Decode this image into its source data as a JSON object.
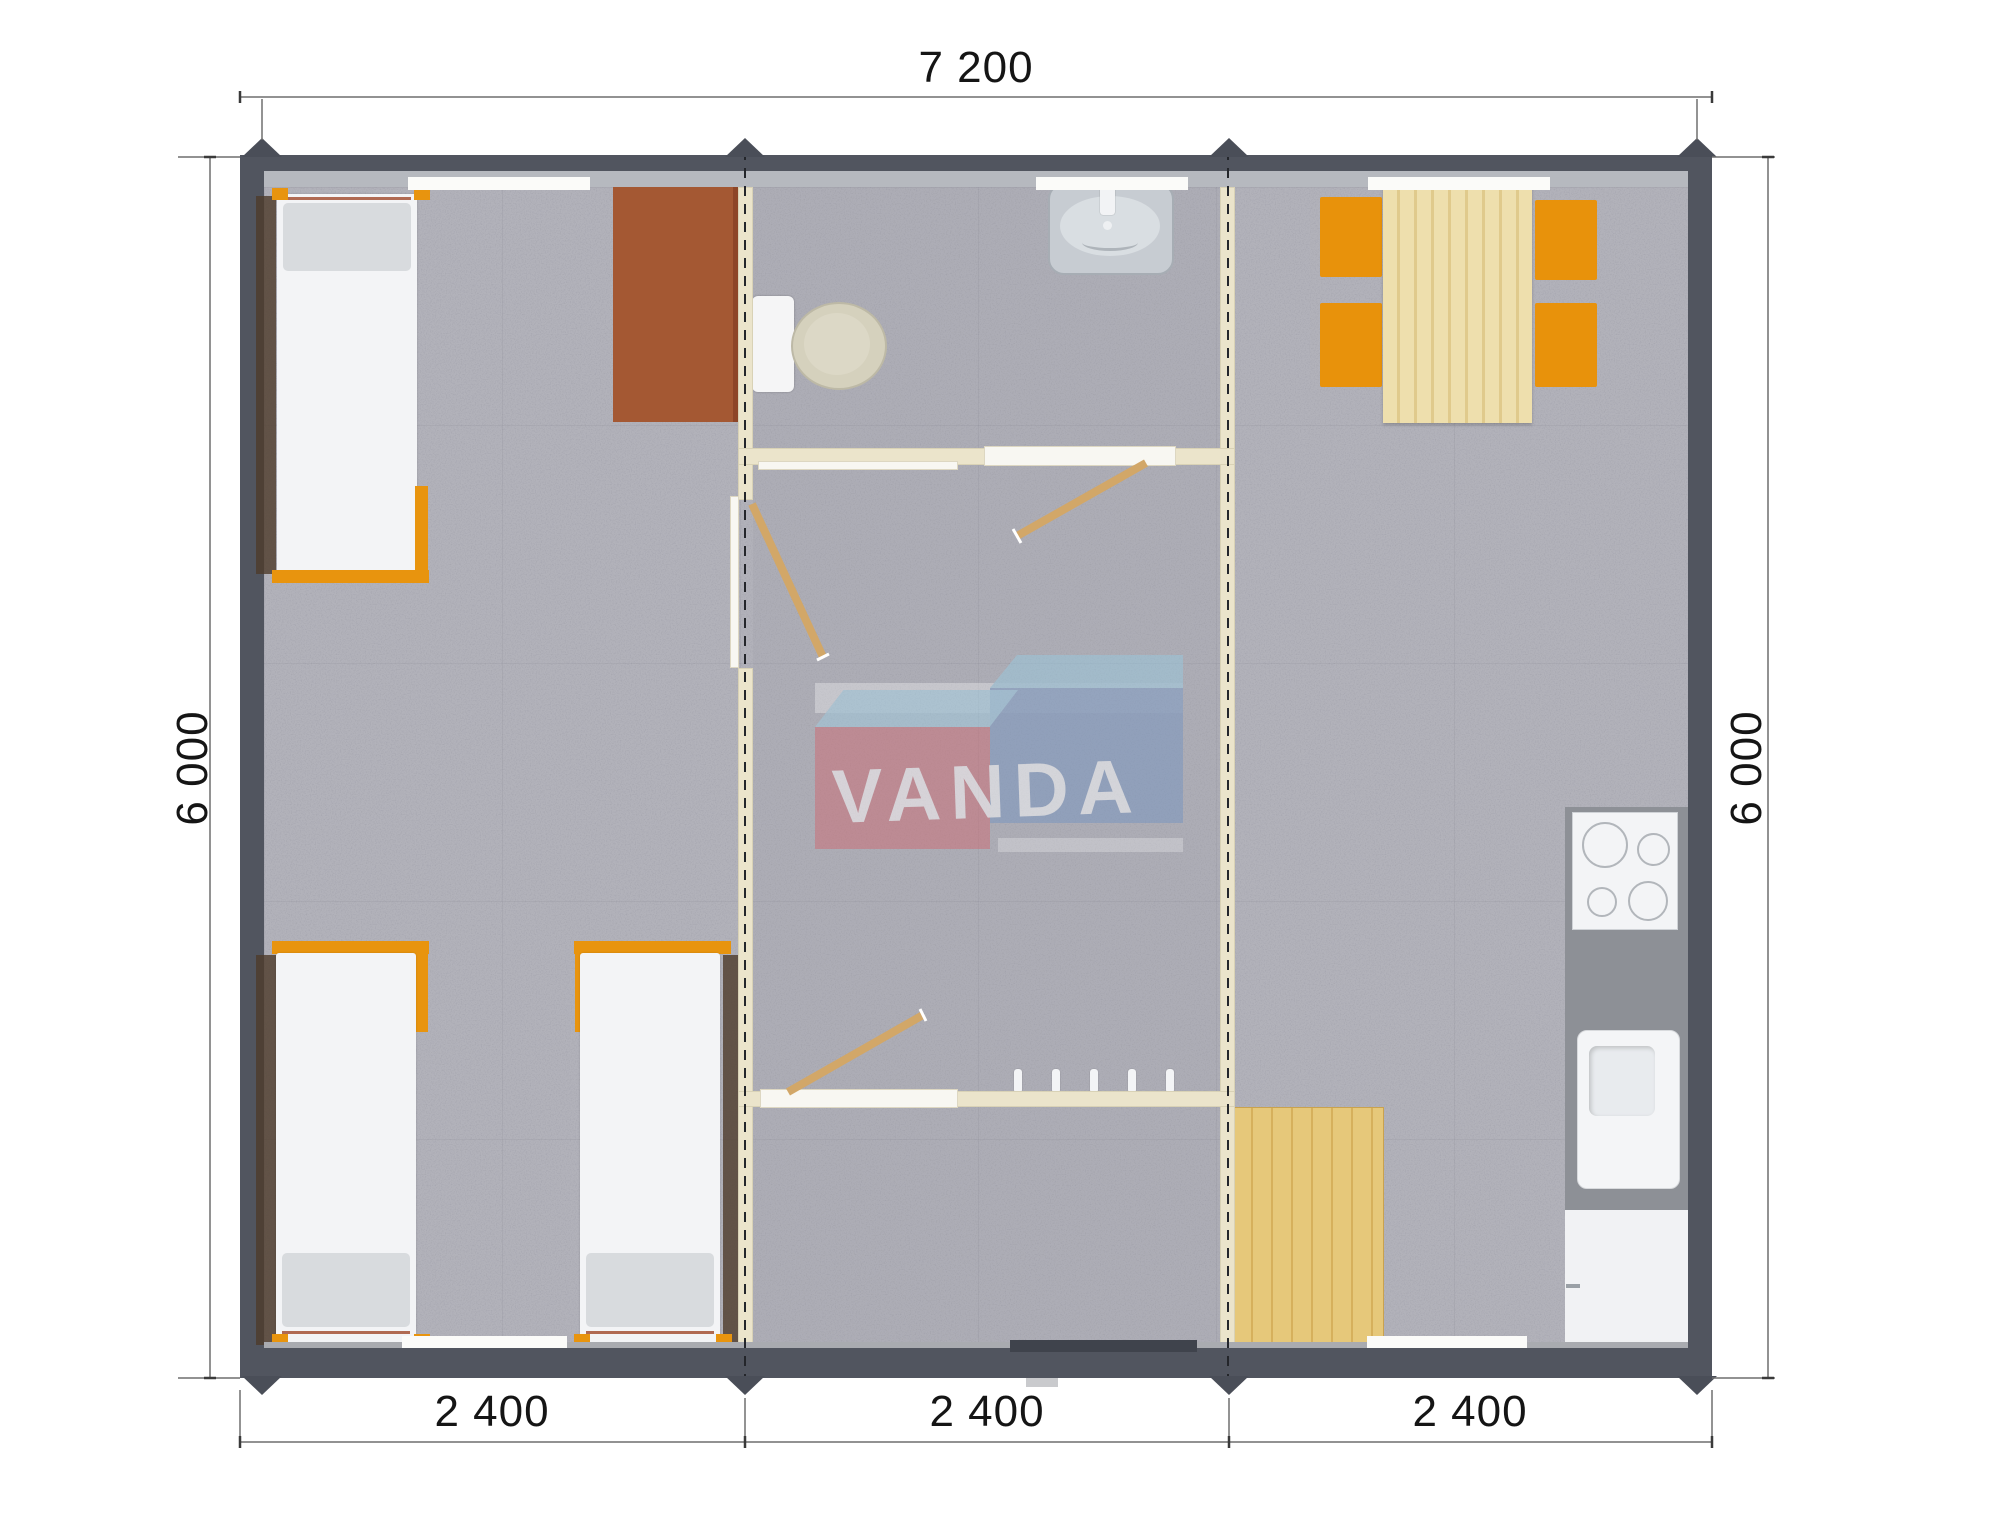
{
  "title": "Modular house floor plan",
  "watermark": {
    "brand": "VANDA",
    "left_text": "VAN",
    "right_text": "DA",
    "box_red": "#d0646c",
    "box_blue": "#7192c0",
    "box_top_light_blue": "#97cde4",
    "letter_color": "#ffffff"
  },
  "dimensions": {
    "top_width": "7 200",
    "bottom_segments": [
      "2 400",
      "2 400",
      "2 400"
    ],
    "left_height": "6 000",
    "right_height": "6 000"
  },
  "building": {
    "exterior_wall_color": "#51555f",
    "interior_wall_color": "#ebe4cb",
    "floor_color": "#b2b2ba",
    "module_joint_line_color": "#24262b",
    "modules": [
      {
        "id": "module-1",
        "rooms": [
          "bedroom"
        ],
        "furniture": [
          "single-bed",
          "single-bed",
          "single-bed",
          "desk"
        ]
      },
      {
        "id": "module-2",
        "rooms": [
          "bathroom",
          "hallway",
          "entry"
        ],
        "furniture": [
          "toilet",
          "washbasin",
          "interior-doors",
          "coat-hooks"
        ]
      },
      {
        "id": "module-3",
        "rooms": [
          "kitchen-dining"
        ],
        "furniture": [
          "dining-table",
          "chair",
          "chair",
          "chair",
          "chair",
          "cooktop",
          "kitchen-sink",
          "base-cabinet",
          "entry-mat"
        ]
      }
    ]
  },
  "accents": {
    "orange_frame": "#e8940e",
    "light_wood": "#ecd9a2",
    "mat_wood": "#e3c272",
    "desk_brown": "#a45833",
    "counter_gray": "#8d9096",
    "door_leaf_tan": "#d2a768"
  }
}
